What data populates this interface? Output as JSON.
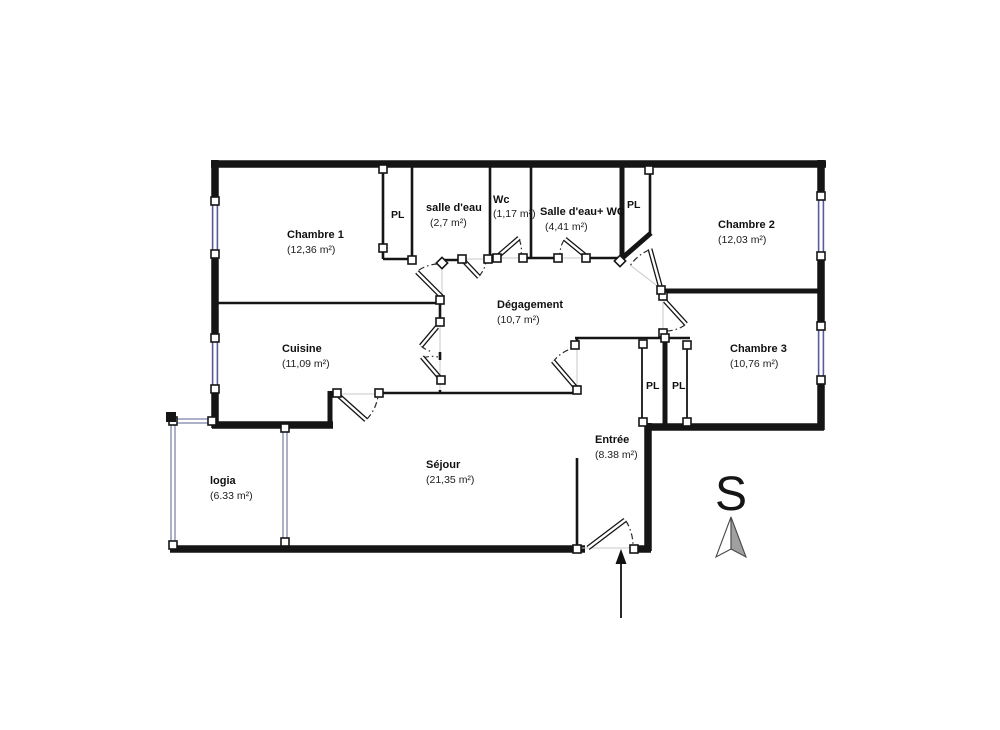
{
  "title": "Plan d'appartement",
  "rooms": {
    "chambre1": {
      "name": "Chambre 1",
      "area": "(12,36 m²)"
    },
    "salle_eau": {
      "name": "salle d'eau",
      "area": "(2,7 m²)"
    },
    "wc": {
      "name": "Wc",
      "area": "(1,17 m²)"
    },
    "salle_eau_wc": {
      "name": "Salle d'eau+ WC",
      "area": "(4,41 m²)"
    },
    "chambre2": {
      "name": "Chambre 2",
      "area": "(12,03 m²)"
    },
    "degagement": {
      "name": "Dégagement",
      "area": "(10,7 m²)"
    },
    "cuisine": {
      "name": "Cuisine",
      "area": "(11,09 m²)"
    },
    "chambre3": {
      "name": "Chambre 3",
      "area": "(10,76 m²)"
    },
    "logia": {
      "name": "logia",
      "area": "(6.33 m²)"
    },
    "sejour": {
      "name": "Séjour",
      "area": "(21,35 m²)"
    },
    "entree": {
      "name": "Entrée",
      "area": "(8.38 m²)"
    }
  },
  "closets": {
    "pl_nord_ouest": "PL",
    "pl_nord_est": "PL",
    "pl_entree": "PL",
    "pl_chambre3": "PL"
  },
  "compass": {
    "label": "S"
  },
  "colors": {
    "wall": "#151515",
    "window_frame": "#5a5aa0",
    "logia_frame": "#8890b0",
    "needle_fill": "#a0a0a0"
  }
}
